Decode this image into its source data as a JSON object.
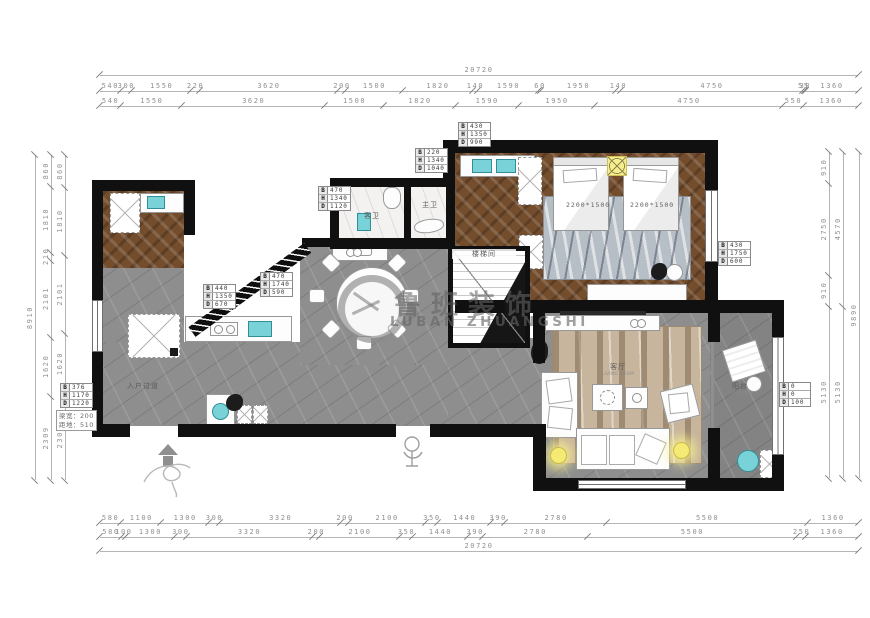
{
  "drawing": {
    "watermark_cn": "鲁班装饰",
    "watermark_en": "LUBAN ZHUANGSHI"
  },
  "dims": {
    "top": {
      "overall": [
        "20720"
      ],
      "fine": [
        "540",
        "300",
        "1550",
        "220",
        "3620",
        "200",
        "1500",
        "1820",
        "140",
        "1590",
        "60",
        "1950",
        "140",
        "4750",
        "55",
        "30",
        "1360"
      ],
      "coarse": [
        "540",
        "1550",
        "3620",
        "1500",
        "1820",
        "1590",
        "1950",
        "4750",
        "550",
        "1360"
      ]
    },
    "bottom": {
      "overall": [
        "20720"
      ],
      "fine_upper": [
        "580",
        "1100",
        "1300",
        "300",
        "3320",
        "200",
        "2100",
        "350",
        "1440",
        "390",
        "2780",
        "5500",
        "1360"
      ],
      "fine_lower": [
        "580",
        "100",
        "1300",
        "300",
        "3320",
        "200",
        "2100",
        "350",
        "1440",
        "390",
        "2780",
        "5500",
        "250",
        "1360"
      ]
    },
    "left": {
      "overall": [
        "8910"
      ],
      "outer": [
        "2309",
        "1620",
        "2101",
        "210",
        "1810",
        "860"
      ],
      "inner": [
        "2309",
        "1620",
        "2101",
        "1810",
        "860"
      ]
    },
    "right": {
      "overall": [
        "9890"
      ],
      "outer": [
        "5130",
        "4570"
      ],
      "inner": [
        "5130",
        "910",
        "2750",
        "910"
      ]
    }
  },
  "bhd_boxes": [
    {
      "b": "220",
      "h": "1340",
      "d": "1040"
    },
    {
      "b": "430",
      "h": "1350",
      "d": "990"
    },
    {
      "b": "470",
      "h": "1340",
      "d": "1120"
    },
    {
      "b": "470",
      "h": "1740",
      "d": "590"
    },
    {
      "b": "440",
      "h": "1350",
      "d": "670"
    },
    {
      "b": "430",
      "h": "1750",
      "d": "600"
    },
    {
      "b": "376",
      "h": "1170",
      "d": "1220"
    },
    {
      "b": "0",
      "h": "0",
      "d": "100"
    }
  ],
  "beam_note": {
    "line1": "梁宽：200",
    "line2": "距地：510"
  },
  "labels": {
    "bath_guest": "客卫",
    "bath_master": "主卫",
    "stairwell": "楼梯间",
    "living_cn": "客厅",
    "living_en": "LIVING ROOM",
    "balcony_cn": "阳台",
    "balcony_en": "BALCONY",
    "corridor": "入户过道",
    "bed1_size": "2200*1500",
    "bed2_size": "2200*1500"
  }
}
